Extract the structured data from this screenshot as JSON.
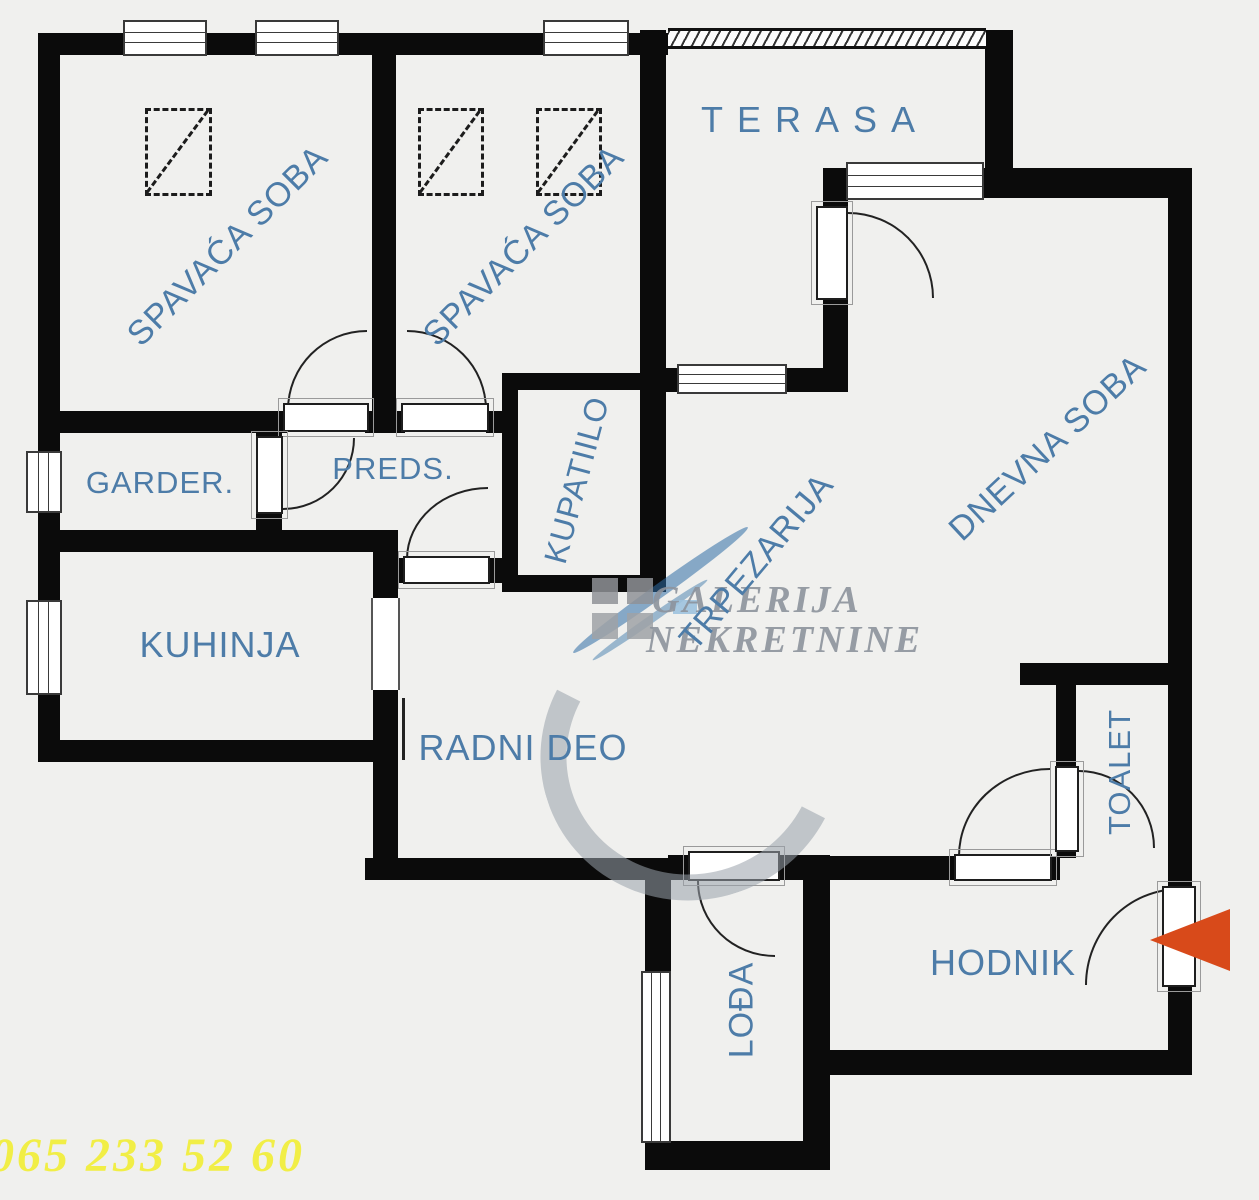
{
  "rooms": {
    "bedroom1": "SPAVAĆA SOBA",
    "bedroom2": "SPAVAĆA SOBA",
    "terrace": "TERASA",
    "wardrobe_room": "GARDER.",
    "hallway": "PREDS.",
    "bathroom": "KUPATIILO",
    "dining": "TRPEZARIJA",
    "living": "DNEVNA SOBA",
    "kitchen": "KUHINJA",
    "work_area": "RADNI DEO",
    "toilet": "TOALET",
    "corridor": "HODNIK",
    "loggia": "LOĐA"
  },
  "watermark": {
    "line1": "GALERIJA",
    "line2": "NEKRETNINE"
  },
  "phone": "065 233 52 60",
  "colors": {
    "label_blue": "#4d7ca8",
    "wall_black": "#0b0b0b",
    "phone_yellow": "#f2ee38",
    "arrow_orange": "#d84a1a",
    "watermark_grey": "#8d939d",
    "watermark_blue": "#2f6ea5"
  }
}
